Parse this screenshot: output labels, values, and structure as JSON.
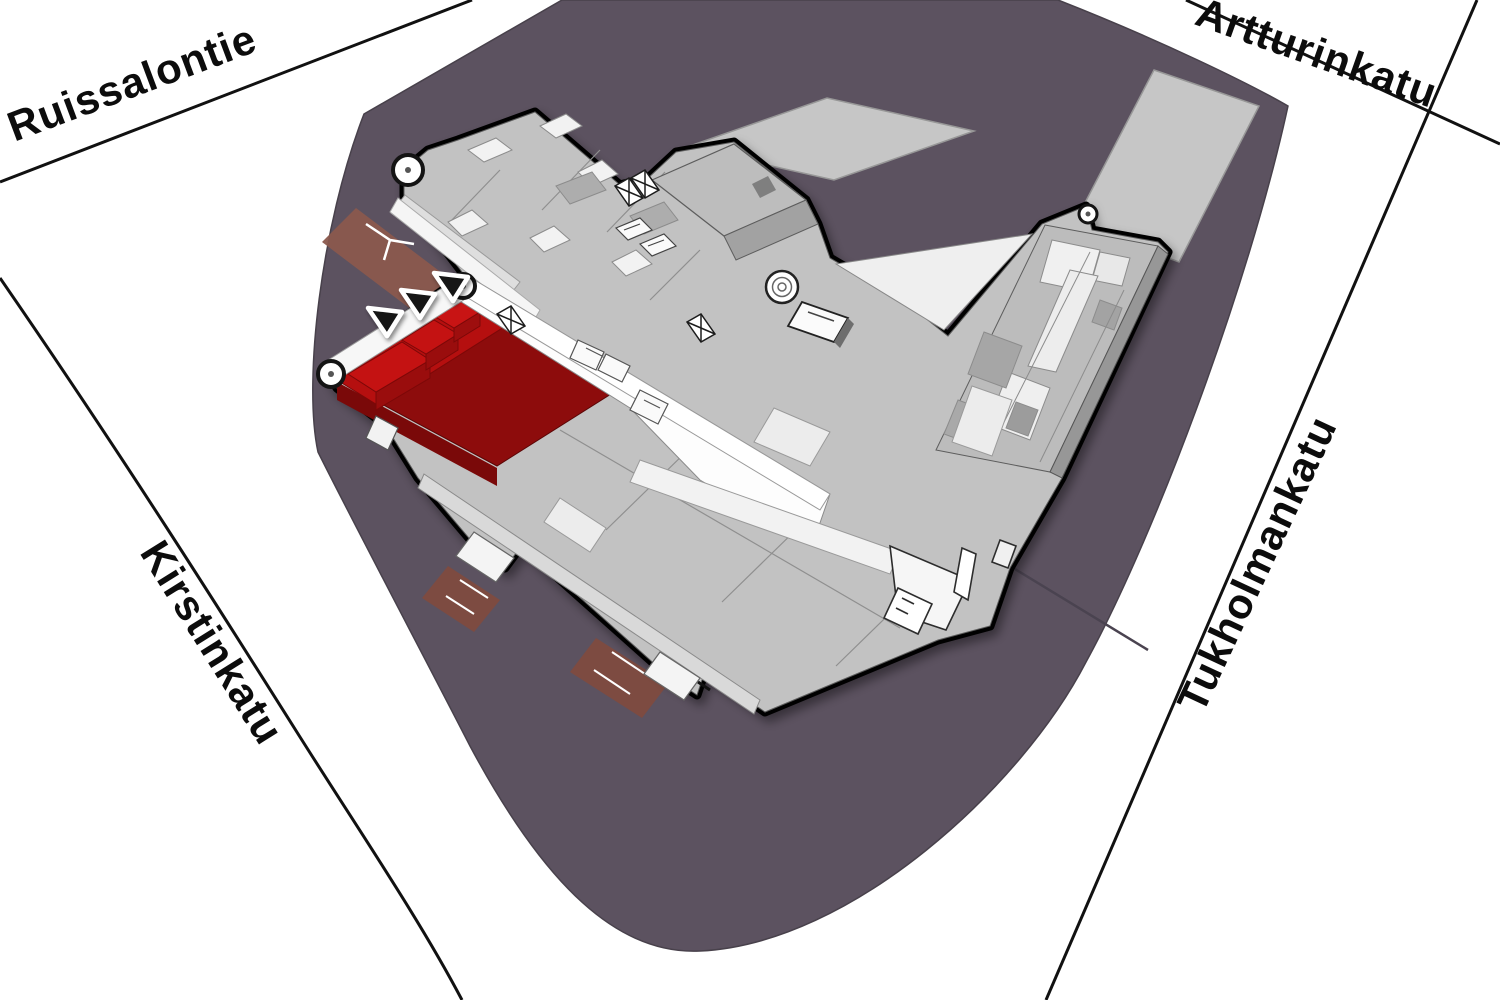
{
  "streets": [
    {
      "id": "ruissalontie",
      "name": "Ruissalontie"
    },
    {
      "id": "artturinkatu",
      "name": "Artturinkatu"
    },
    {
      "id": "tukholmankatu",
      "name": "Tukholmankatu"
    },
    {
      "id": "kirstinkatu",
      "name": "Kirstinkatu"
    }
  ],
  "map": {
    "type": "isometric-campus-plan",
    "highlighted_wing": {
      "color_dark": "#8d0c0c",
      "color_bright": "#b50f0f",
      "entrance_arrow_count": 3
    },
    "colors": {
      "background": "#ffffff",
      "ground_block": "#5c5260",
      "building_roof": "#c2c2c2",
      "building_outline": "#000000",
      "parking_area": "#c6c6c6",
      "entrance_ramp": "#8a594d",
      "walkway_white": "#f7f7f7",
      "street_line": "#111111"
    },
    "icons": {
      "entrance_arrow": "black triangle with white halo",
      "stair_tower": "white cylinder with dark ring",
      "spiral_ramp": "white cylinder with concentric rings",
      "skylight_x": "white box with black X"
    }
  }
}
